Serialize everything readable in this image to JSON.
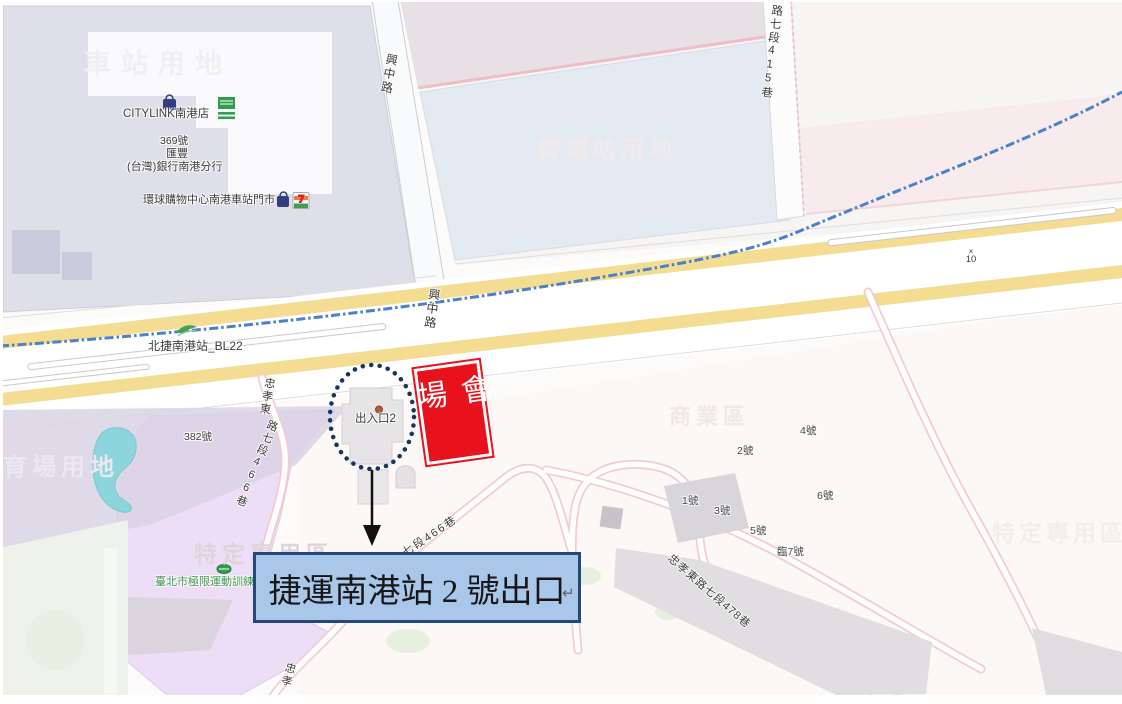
{
  "zones": {
    "station_land": "車站用地",
    "transfer_land": "轉運站用地",
    "stadium_land": "育場用地",
    "special_purpose_left": "特定專用區",
    "special_purpose_right": "特定專用區",
    "commercial": "商業區"
  },
  "roads": {
    "xingzhong_top": "興中路",
    "xingzhong_cross": "興中路",
    "lane_415": "路七段415巷",
    "lane_466_a": "忠孝東",
    "lane_466_b": "路七段466巷",
    "lane_466_diagonal": "七段466巷",
    "lane_478": "忠孝東路七段478巷",
    "zhongxiao_south": "忠孝"
  },
  "transit": {
    "station_label": "北捷南港站_BL22"
  },
  "pois": {
    "citylink": "CITYLINK南港店",
    "bank_number": "369號",
    "bank_name_1": "匯豐",
    "bank_name_2": "(台灣)銀行南港分行",
    "global_mall": "環球購物中心南港車站門市",
    "extreme_sports": "臺北市極限運動訓練",
    "exit_poi": "出入口2"
  },
  "house_numbers": {
    "n382": "382號",
    "n1": "1號",
    "n2": "2號",
    "n3": "3號",
    "n4": "4號",
    "n5": "5號",
    "n6": "6號",
    "n7": "臨7號"
  },
  "road_markers": {
    "cross": "×",
    "value": "10"
  },
  "annotations": {
    "venue": "會場",
    "exit_callout": "捷運南港站 2 號出口",
    "return_mark": "↵"
  },
  "colors": {
    "venue_red": "#E8121D",
    "callout_fill": "#A9C7E8",
    "callout_border": "#24477D",
    "railway_blue": "#4B80CB",
    "road_yellow": "#F4DD92",
    "circle_navy": "#17365D",
    "area_purple": "#EDDDF6",
    "pond_teal": "#8CD5DD"
  }
}
